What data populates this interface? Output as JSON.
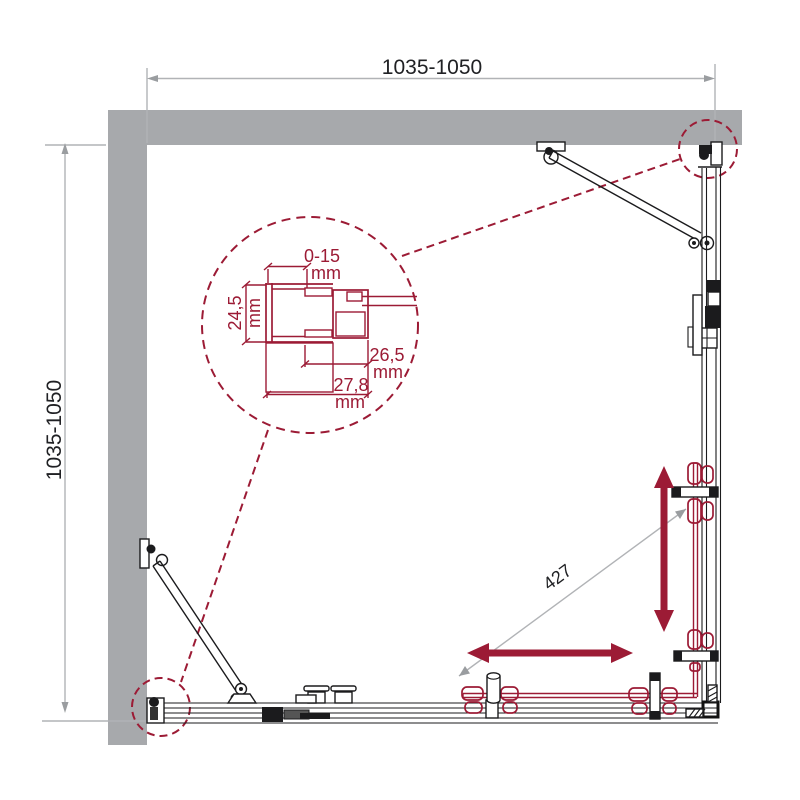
{
  "colors": {
    "wall_gray": "#a7a9ac",
    "dimension_gray": "#b1b3b6",
    "accent_red": "#9c1b35",
    "line_black": "#1b1b1d"
  },
  "dimensions": {
    "top_width": {
      "label": "1035-1050"
    },
    "left_height": {
      "label": "1035-1050"
    },
    "door_panel": {
      "label": "427"
    }
  },
  "detail": {
    "adjustment": {
      "value": "0-15",
      "unit": "mm"
    },
    "profile_height": {
      "value": "24,5",
      "unit": "mm"
    },
    "inner_depth": {
      "value": "26,5",
      "unit": "mm"
    },
    "outer_depth": {
      "value": "27,8",
      "unit": "mm"
    }
  }
}
